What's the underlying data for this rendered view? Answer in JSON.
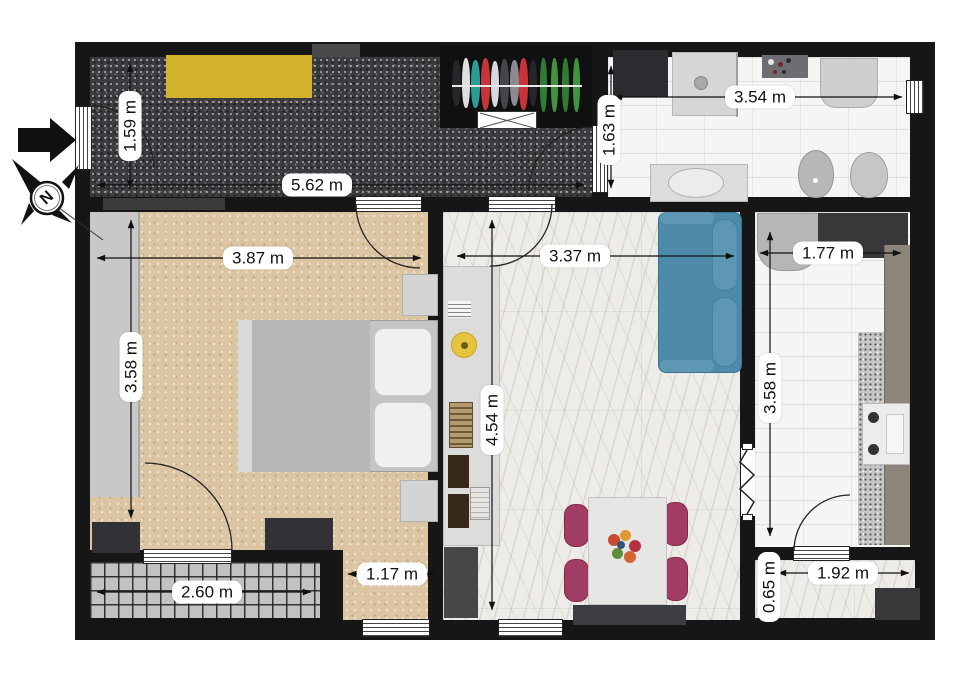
{
  "compass": {
    "label": "N"
  },
  "dimensions": {
    "hallway_width": "5.62 m",
    "hallway_depth": "1.59 m",
    "bathroom_width": "3.54 m",
    "bathroom_depth": "1.63 m",
    "bedroom_width": "3.87 m",
    "bedroom_depth": "3.58 m",
    "living_width": "3.37 m",
    "living_depth": "4.54 m",
    "kitchen_width": "1.77 m",
    "kitchen_depth": "3.58 m",
    "balcony_left_width": "2.60 m",
    "bedroom_nook_width": "1.17 m",
    "balcony_right_width": "1.92 m",
    "balcony_right_depth": "0.65 m"
  },
  "colors": {
    "wall": "#161616",
    "sofa_blue": "#4e8bab",
    "dining_chair_pink": "#a13c63",
    "doormat_yellow": "#d2b32b",
    "hallway_carpet": "#3b3b40",
    "bedroom_floor": "#dcc5a3",
    "living_marble": "#eeece9",
    "bath_tile": "#f5f5f4",
    "balcony_tile": "#c2c2c2"
  }
}
